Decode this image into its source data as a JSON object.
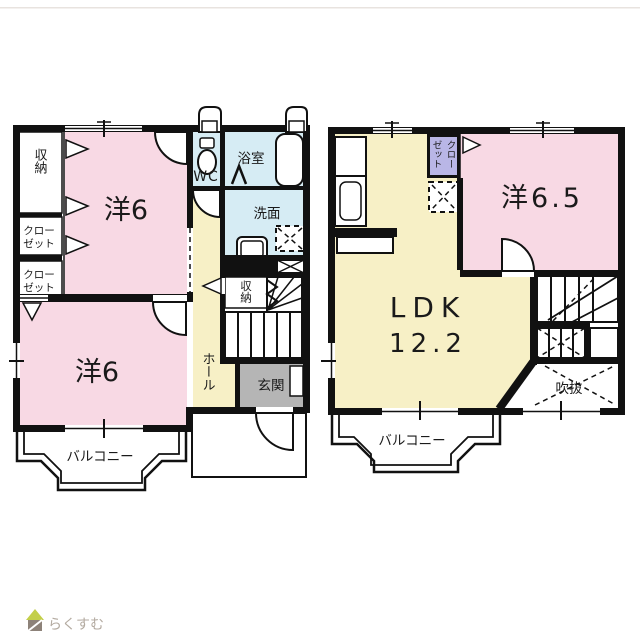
{
  "palette": {
    "pink": "#f8d9e4",
    "yellow": "#f7f0c6",
    "blue": "#d6ecf4",
    "purple": "#b9b6e6",
    "gray": "#b5b5b5",
    "wall": "#111111",
    "logo_green": "#c3cf49",
    "logo_brown": "#8d8279",
    "logo_text_color": "#b3aaa0",
    "top_rule": "#e8e3df"
  },
  "floor1": {
    "storage_top": "収納",
    "closet1_line1": "クロー",
    "closet1_line2": "ゼット",
    "closet2_line1": "クロー",
    "closet2_line2": "ゼット",
    "bedroom_top": "洋6",
    "wc": "WC",
    "bath": "浴室",
    "wash": "洗面",
    "storage_stairs": "収納",
    "hall": "ホール",
    "entrance": "玄関",
    "bedroom_bottom": "洋6",
    "balcony": "バルコニー"
  },
  "floor2": {
    "closet_col1": "クロー",
    "closet_col2": "ゼット",
    "bedroom": "洋6.5",
    "ldk_line1": "LDK",
    "ldk_line2": "12.2",
    "void": "吹抜",
    "balcony": "バルコニー"
  },
  "logo": {
    "text": "らくすむ"
  }
}
